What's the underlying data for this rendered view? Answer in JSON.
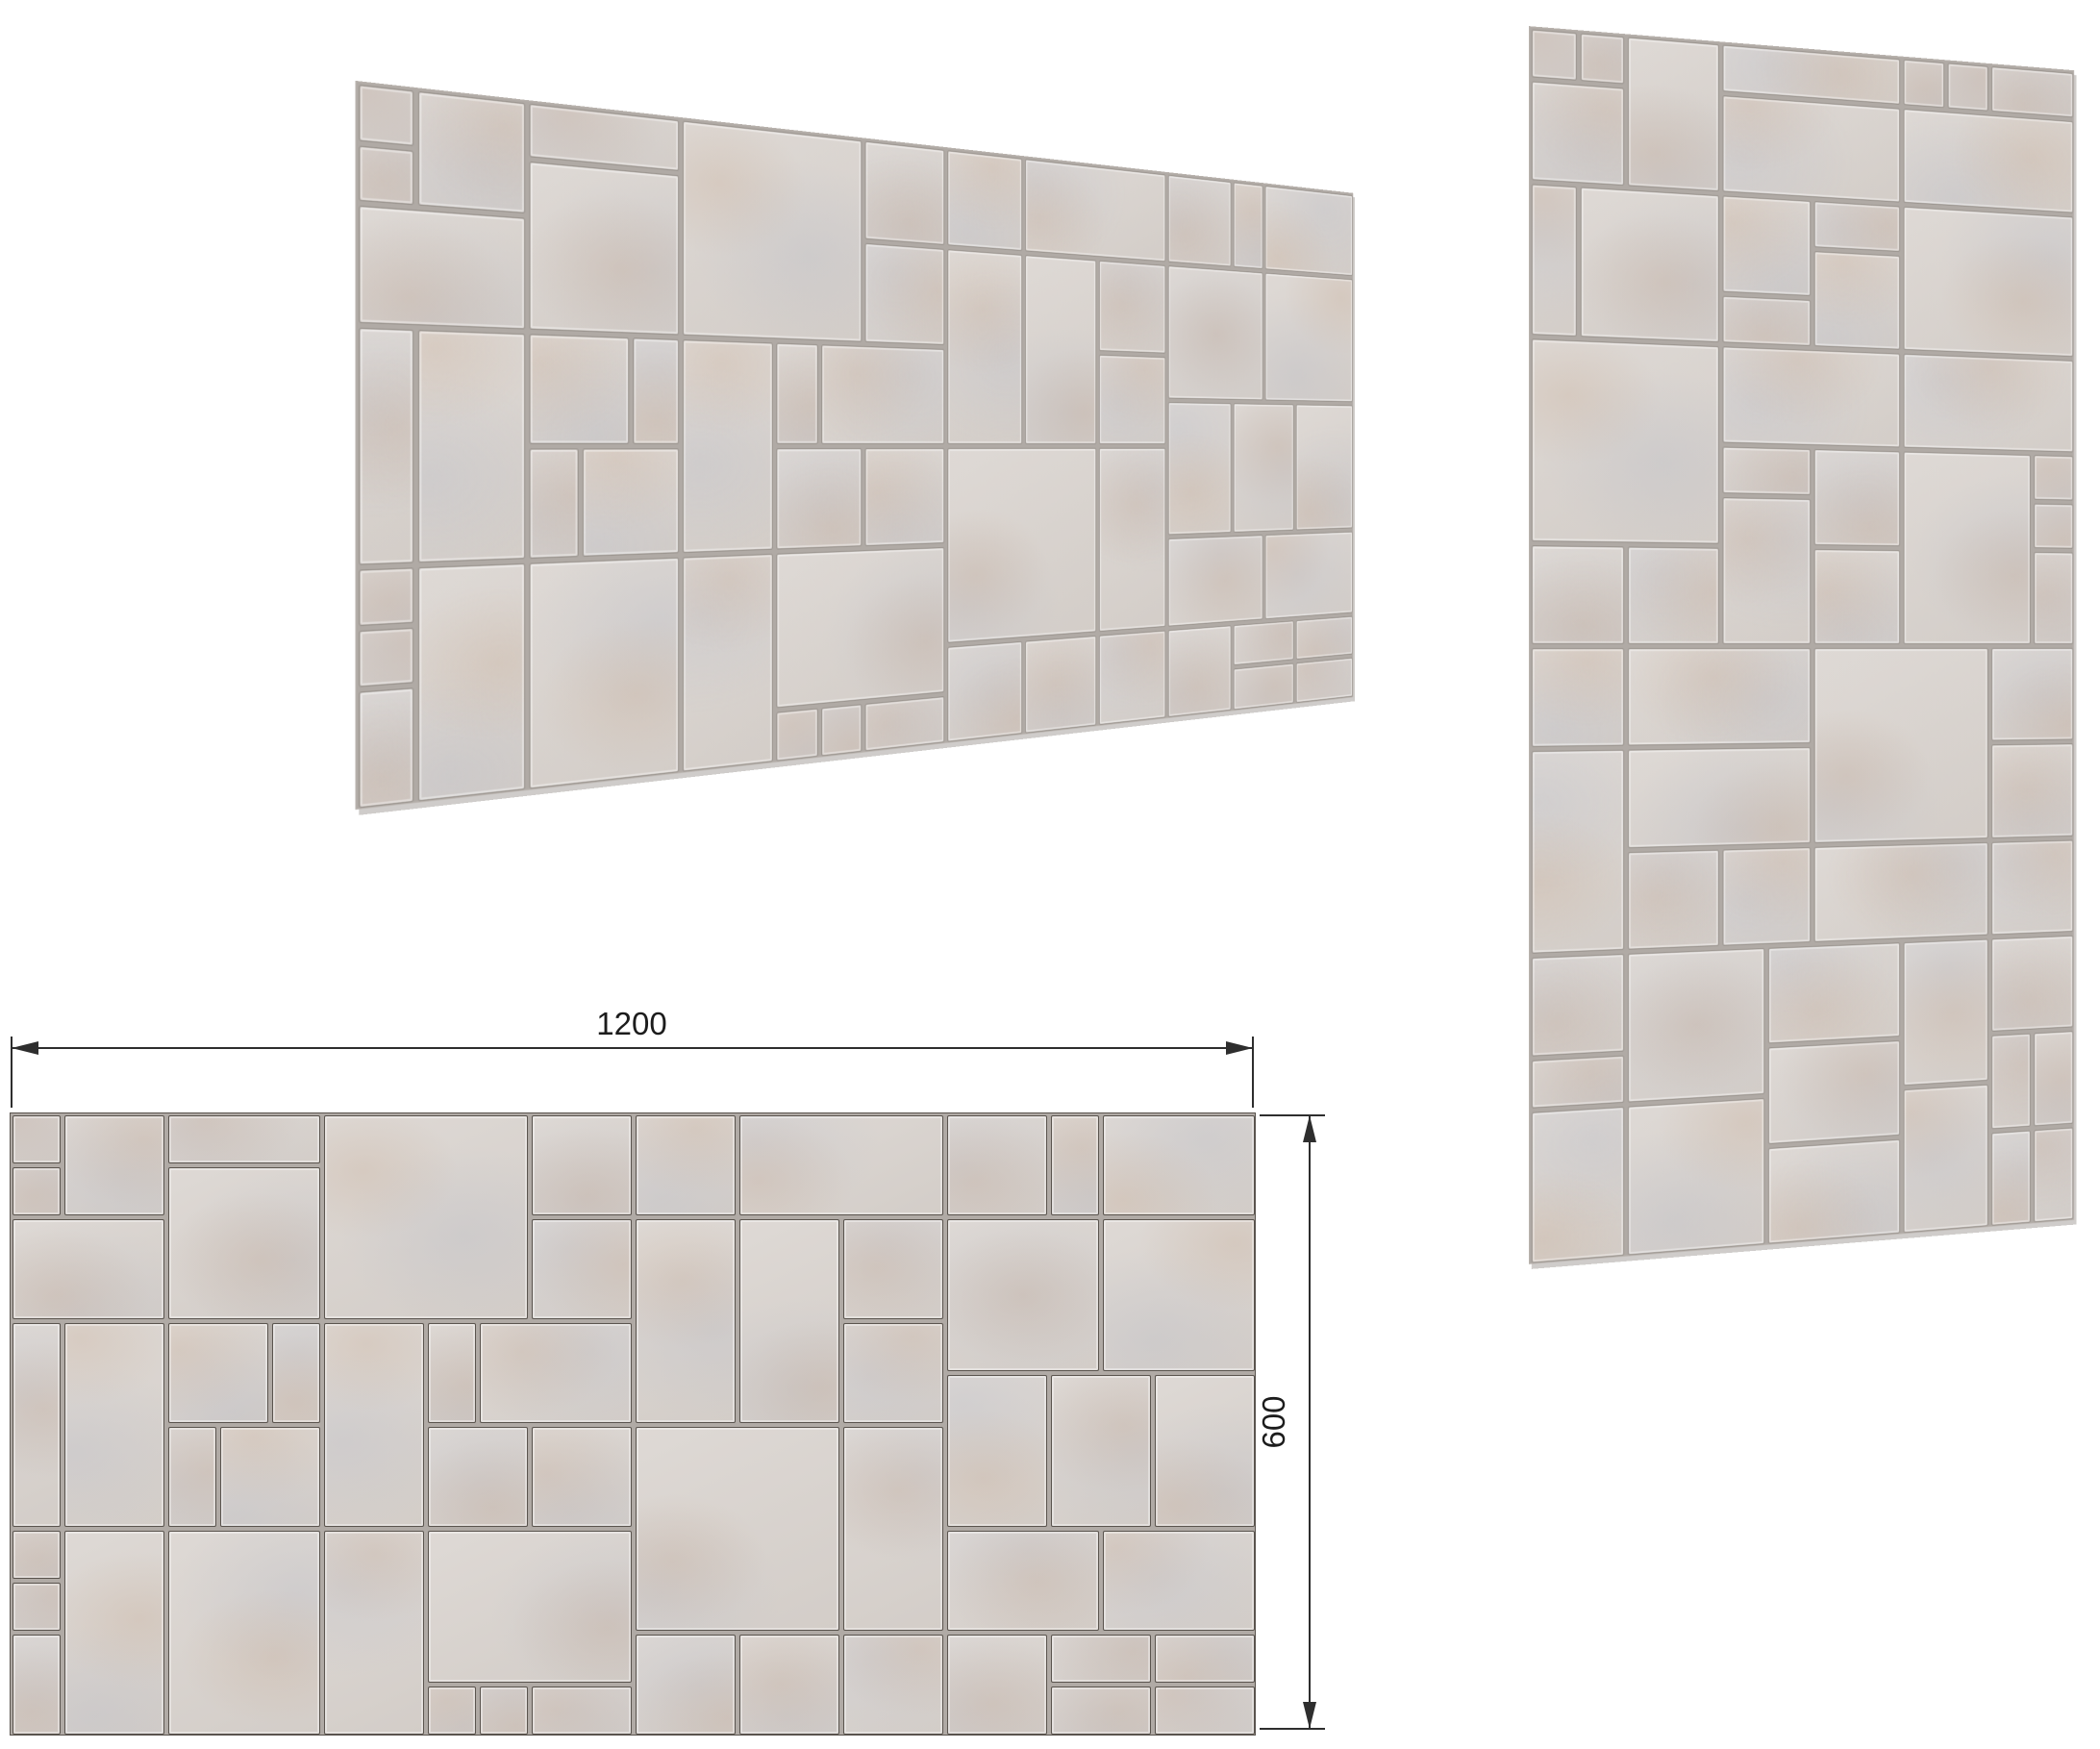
{
  "dimensions": {
    "width_label": "1200",
    "height_label": "600"
  },
  "panel": {
    "width_mm": 1200,
    "height_mm": 600,
    "tiles": [
      [
        0,
        0,
        50,
        50
      ],
      [
        0,
        50,
        50,
        50
      ],
      [
        50,
        0,
        100,
        100
      ],
      [
        0,
        100,
        150,
        100
      ],
      [
        0,
        200,
        50,
        200
      ],
      [
        50,
        200,
        100,
        200
      ],
      [
        0,
        400,
        50,
        50
      ],
      [
        0,
        450,
        50,
        50
      ],
      [
        0,
        500,
        50,
        100
      ],
      [
        50,
        400,
        100,
        200
      ],
      [
        150,
        0,
        150,
        50
      ],
      [
        150,
        50,
        150,
        150
      ],
      [
        150,
        200,
        100,
        100
      ],
      [
        250,
        200,
        50,
        100
      ],
      [
        150,
        300,
        50,
        100
      ],
      [
        200,
        300,
        100,
        100
      ],
      [
        150,
        400,
        150,
        200
      ],
      [
        300,
        0,
        200,
        200
      ],
      [
        500,
        0,
        100,
        100
      ],
      [
        500,
        100,
        100,
        100
      ],
      [
        300,
        200,
        100,
        200
      ],
      [
        400,
        200,
        50,
        100
      ],
      [
        450,
        200,
        150,
        100
      ],
      [
        400,
        300,
        100,
        100
      ],
      [
        500,
        300,
        100,
        100
      ],
      [
        300,
        400,
        100,
        200
      ],
      [
        400,
        400,
        200,
        150
      ],
      [
        400,
        550,
        50,
        50
      ],
      [
        450,
        550,
        50,
        50
      ],
      [
        500,
        550,
        100,
        50
      ],
      [
        600,
        0,
        100,
        100
      ],
      [
        700,
        0,
        200,
        100
      ],
      [
        600,
        100,
        100,
        200
      ],
      [
        700,
        100,
        100,
        200
      ],
      [
        800,
        100,
        100,
        100
      ],
      [
        800,
        200,
        100,
        100
      ],
      [
        600,
        300,
        200,
        200
      ],
      [
        800,
        300,
        100,
        200
      ],
      [
        600,
        500,
        100,
        100
      ],
      [
        700,
        500,
        100,
        100
      ],
      [
        800,
        500,
        100,
        100
      ],
      [
        900,
        0,
        100,
        100
      ],
      [
        1000,
        0,
        50,
        100
      ],
      [
        1050,
        0,
        150,
        100
      ],
      [
        900,
        100,
        150,
        150
      ],
      [
        1050,
        100,
        150,
        150
      ],
      [
        900,
        250,
        100,
        150
      ],
      [
        1000,
        250,
        100,
        150
      ],
      [
        1100,
        250,
        100,
        150
      ],
      [
        900,
        400,
        150,
        100
      ],
      [
        1050,
        400,
        150,
        100
      ],
      [
        900,
        500,
        100,
        100
      ],
      [
        1000,
        500,
        100,
        50
      ],
      [
        1100,
        500,
        100,
        50
      ],
      [
        1000,
        550,
        100,
        50
      ],
      [
        1100,
        550,
        100,
        50
      ]
    ]
  },
  "colors": {
    "page_bg": "#ffffff",
    "tile_light": "#ded9d5",
    "tile_dark": "#d3cdc8",
    "joint": "#b0aaa5",
    "outline": "#5a544e",
    "speckle_warm": "rgba(201,174,152,0.30)",
    "speckle_cool": "rgba(182,186,198,0.28)",
    "dimension": "#2e2e2e"
  }
}
